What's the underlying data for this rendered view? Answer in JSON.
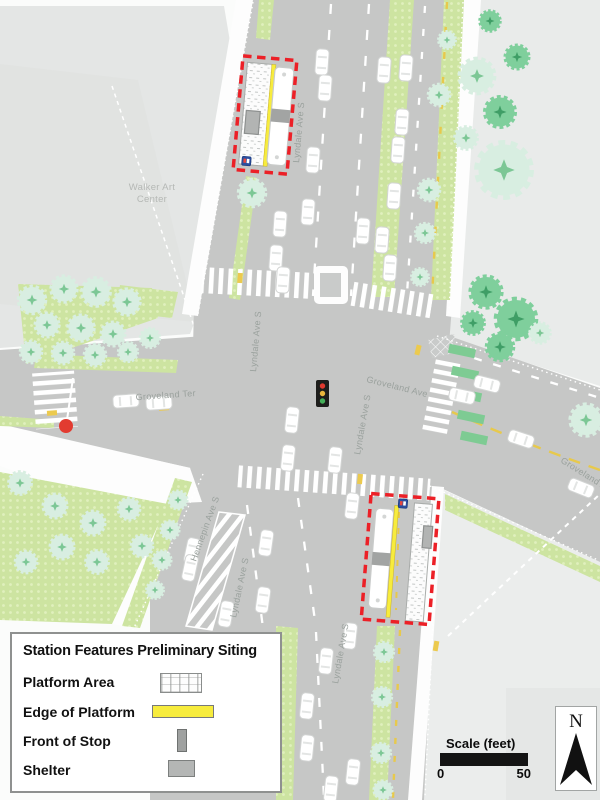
{
  "map": {
    "labels": {
      "walker_line1": "Walker Art",
      "walker_line2": "Center",
      "lyndale_top": "Lyndale Ave S",
      "lyndale_north_inner": "Lyndale Ave S",
      "lyndale_mid": "Lyndale Ave S",
      "lyndale_south_upper": "Lyndale Ave S",
      "lyndale_south_lower": "Lyndale Ave S",
      "hennepin": "Hennepin Ave S",
      "groveland_ter": "Groveland Ter",
      "groveland_ave": "Groveland Ave",
      "groveland_ave_far": "Groveland Ave"
    },
    "colors": {
      "road": "#c6c7c6",
      "block": "#e7e9e8",
      "boulevard_green": "#cde4a1",
      "tree_dark": "#7fcf9c",
      "tree_light": "#d8eee1",
      "station_outline_red": "#ec2027",
      "platform_edge_yellow": "#f7ec3d",
      "shelter_gray": "#b2b4b3",
      "centerline_yellow": "#e7c94c",
      "signal_red": "#e23b30",
      "stop_sign_blue": "#2b4ea0"
    }
  },
  "legend": {
    "title": "Station Features Preliminary Siting",
    "items": [
      {
        "label": "Platform Area",
        "swatch": "platform"
      },
      {
        "label": "Edge of Platform",
        "swatch": "edge"
      },
      {
        "label": "Front of Stop",
        "swatch": "front"
      },
      {
        "label": "Shelter",
        "swatch": "shelter"
      }
    ]
  },
  "scale": {
    "title": "Scale (feet)",
    "start": "0",
    "end": "50"
  },
  "compass": {
    "north": "N"
  }
}
